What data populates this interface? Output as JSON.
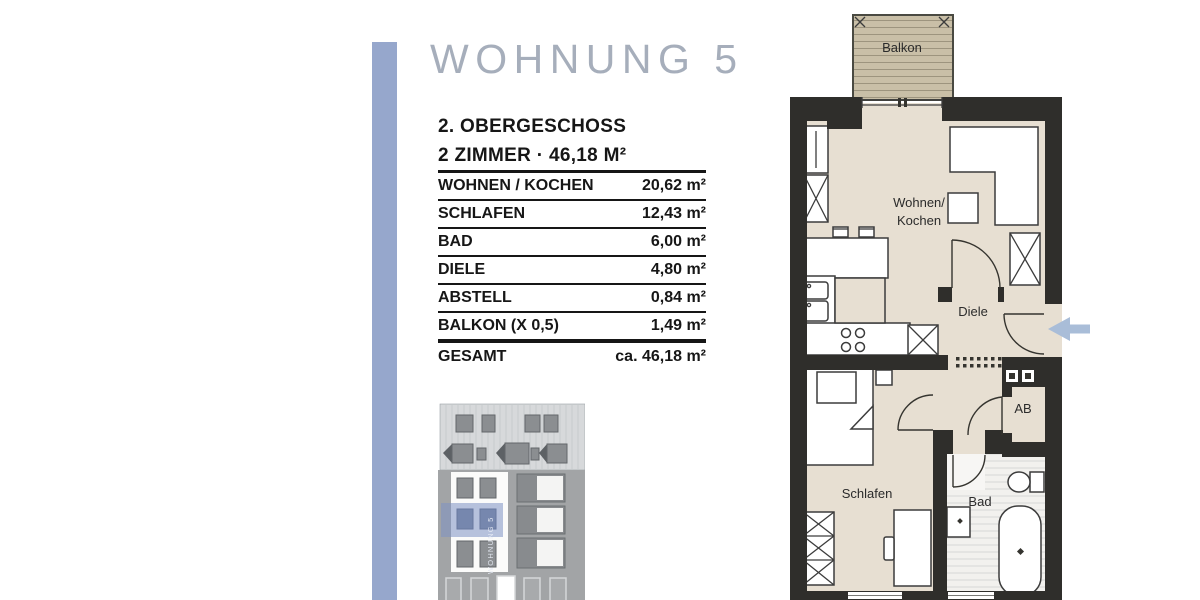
{
  "title": "WOHNUNG 5",
  "subtitle": {
    "floor": "2. OBERGESCHOSS",
    "rooms": "2 ZIMMER · 46,18 M²"
  },
  "area_table": {
    "rows": [
      {
        "label": "WOHNEN / KOCHEN",
        "value": "20,62 m²"
      },
      {
        "label": "SCHLAFEN",
        "value": "12,43 m²"
      },
      {
        "label": "BAD",
        "value": "6,00 m²"
      },
      {
        "label": "DIELE",
        "value": "4,80 m²"
      },
      {
        "label": "ABSTELL",
        "value": "0,84 m²"
      },
      {
        "label": "BALKON (X 0,5)",
        "value": "1,49 m²"
      }
    ],
    "total": {
      "label": "GESAMT",
      "value": "ca. 46,18 m²"
    }
  },
  "floor_plan": {
    "room_labels": {
      "balkon": "Balkon",
      "wohnen_line1": "Wohnen/",
      "wohnen_line2": "Kochen",
      "diele": "Diele",
      "abstell": "AB",
      "schlafen": "Schlafen",
      "bad": "Bad"
    }
  },
  "elevation": {
    "vertical_caption": "WOHNUNG 5"
  },
  "colors": {
    "accent-bar": "#96a7cc",
    "title": "#a6aebb",
    "text": "#161616",
    "wall": "#2f2e2b",
    "floor": "#e7dfd2",
    "balcony": "#c9bfa7",
    "balcony-line": "#9d947e",
    "furniture-line": "#3c3c3c",
    "arrow": "#a9bdd8",
    "bad-stripe": "#d6d6d6",
    "elev-attic": "#d7d9db",
    "elev-facade": "#a2a4a6",
    "elev-window": "#8b8e91",
    "elev-highlight": "#7d91c3"
  }
}
